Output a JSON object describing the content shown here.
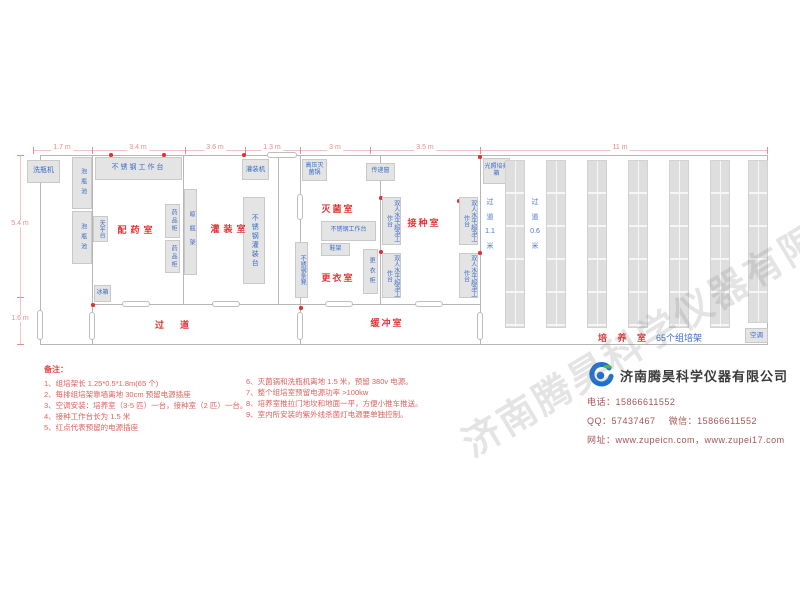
{
  "colors": {
    "room_label_red": "#e03535",
    "equipment_label_blue": "#3b6cc5",
    "dimension_pink": "#e58c8c",
    "note_red": "#e06060",
    "wall_gray": "#b6b6b6",
    "box_fill": "#e4e4e4",
    "outlet_dot_red": "#e03030",
    "company_name_gray": "#3a3a3a",
    "contact_red": "#a85454",
    "logo_blue": "#1d6fd1",
    "logo_green": "#52b543"
  },
  "watermark": "济南腾昊科学仪器有限公司",
  "dimensions": {
    "top": [
      "1.7 m",
      "3.4 m",
      "3.6 m",
      "1.3 m",
      "3 m",
      "3.5 m",
      "11 m"
    ],
    "left": [
      "5.4 m",
      "1.6 m"
    ]
  },
  "rooms": {
    "peiyao": "配药室",
    "guanzhuang": "灌装室",
    "guodao": "过道",
    "miejun": "灭菌室",
    "gengyi": "更衣室",
    "huanchong": "缓冲室",
    "jiezhong": "接种室",
    "peiyang": "培 养 室",
    "peiyang_note": "65个组培架"
  },
  "aisles": {
    "wide": "过 道 1.1 米",
    "narrow": "过 道 0.6 米"
  },
  "equipment": {
    "bottle_washer": "洗瓶机",
    "soak_pool": "泡瓶池",
    "ss_worktable": "不锈钢工作台",
    "balance_table": "天平台",
    "medicine_cabinet": "药品柜",
    "drying_rack": "晾瓶架",
    "filling_machine": "灌装机",
    "ss_filling_table": "不锈钢灌装台",
    "fridge": "冰箱",
    "autoclave": "高压灭菌锅",
    "pass_window": "传递窗",
    "shoe_rack": "鞋架",
    "locker": "更衣柜",
    "ss_bench": "不锈钢条凳",
    "clean_bench": "双人水平超净工作台",
    "light_incubator": "光照培养箱",
    "ac": "空调"
  },
  "notes": {
    "header": "备注：",
    "col1": [
      "1、组培架长 1.25*0.5*1.8m(65 个)",
      "2、每排组培架靠墙离地 30cm 预留电源插座",
      "3、空调安装：培养室（3-5 匹）一台，接种室（2 匹）一台。",
      "4、接种工作台长为 1.5 米",
      "5、红点代表预留的电源插座"
    ],
    "col2": [
      "6、灭菌锅和洗瓶机离地 1.5 米，预留 380v 电源。",
      "7、整个组培室预留电源功率 >100kw",
      "8、培养室推拉门地坎和地面一平，方便小推车推送。",
      "9、室内所安装的紫外线杀菌灯电源要单独控制。"
    ]
  },
  "company": {
    "name": "济南腾昊科学仪器有限公司",
    "phone_label": "电话：",
    "phone": "15866611552",
    "qq_label": "QQ：",
    "qq": "57437467",
    "wechat_label": "微信：",
    "wechat": "15866611552",
    "web_label": "网址：",
    "web": "www.zupeicn.com，www.zupei17.com"
  }
}
